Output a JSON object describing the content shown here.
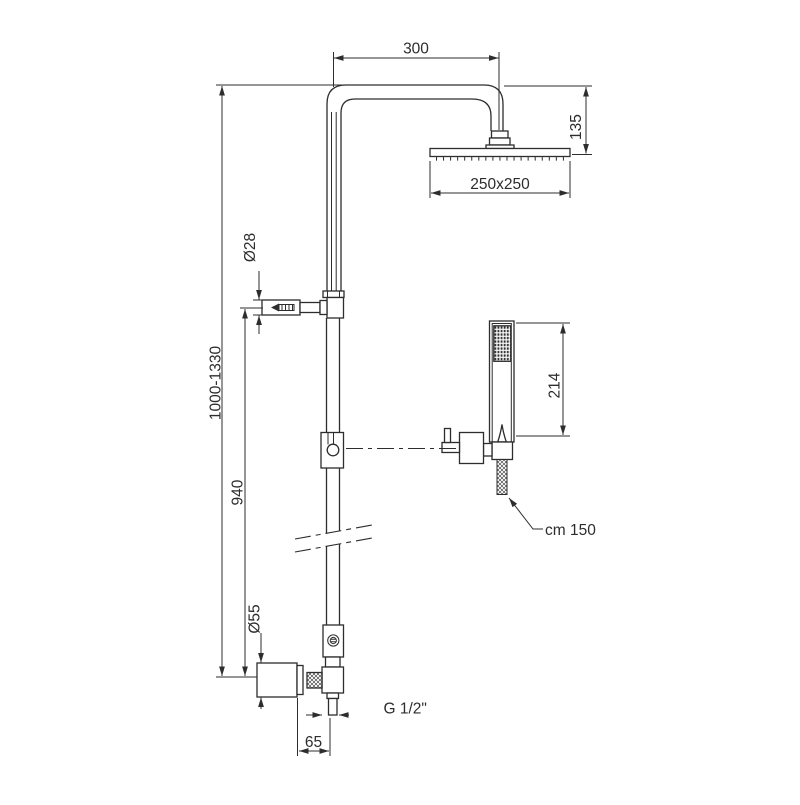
{
  "drawing": {
    "background": "#ffffff",
    "line_color": "#2d2d2d",
    "labels": {
      "arm_width": "300",
      "head_drop": "135",
      "head_size": "250x250",
      "bracket_diameter": "Ø28",
      "total_height": "1000-1330",
      "bracket_distance": "940",
      "handshower_length": "214",
      "hose_length": "cm 150",
      "flange_diameter": "Ø55",
      "outlet_thread": "G 1/2\"",
      "outlet_offset": "65"
    }
  }
}
